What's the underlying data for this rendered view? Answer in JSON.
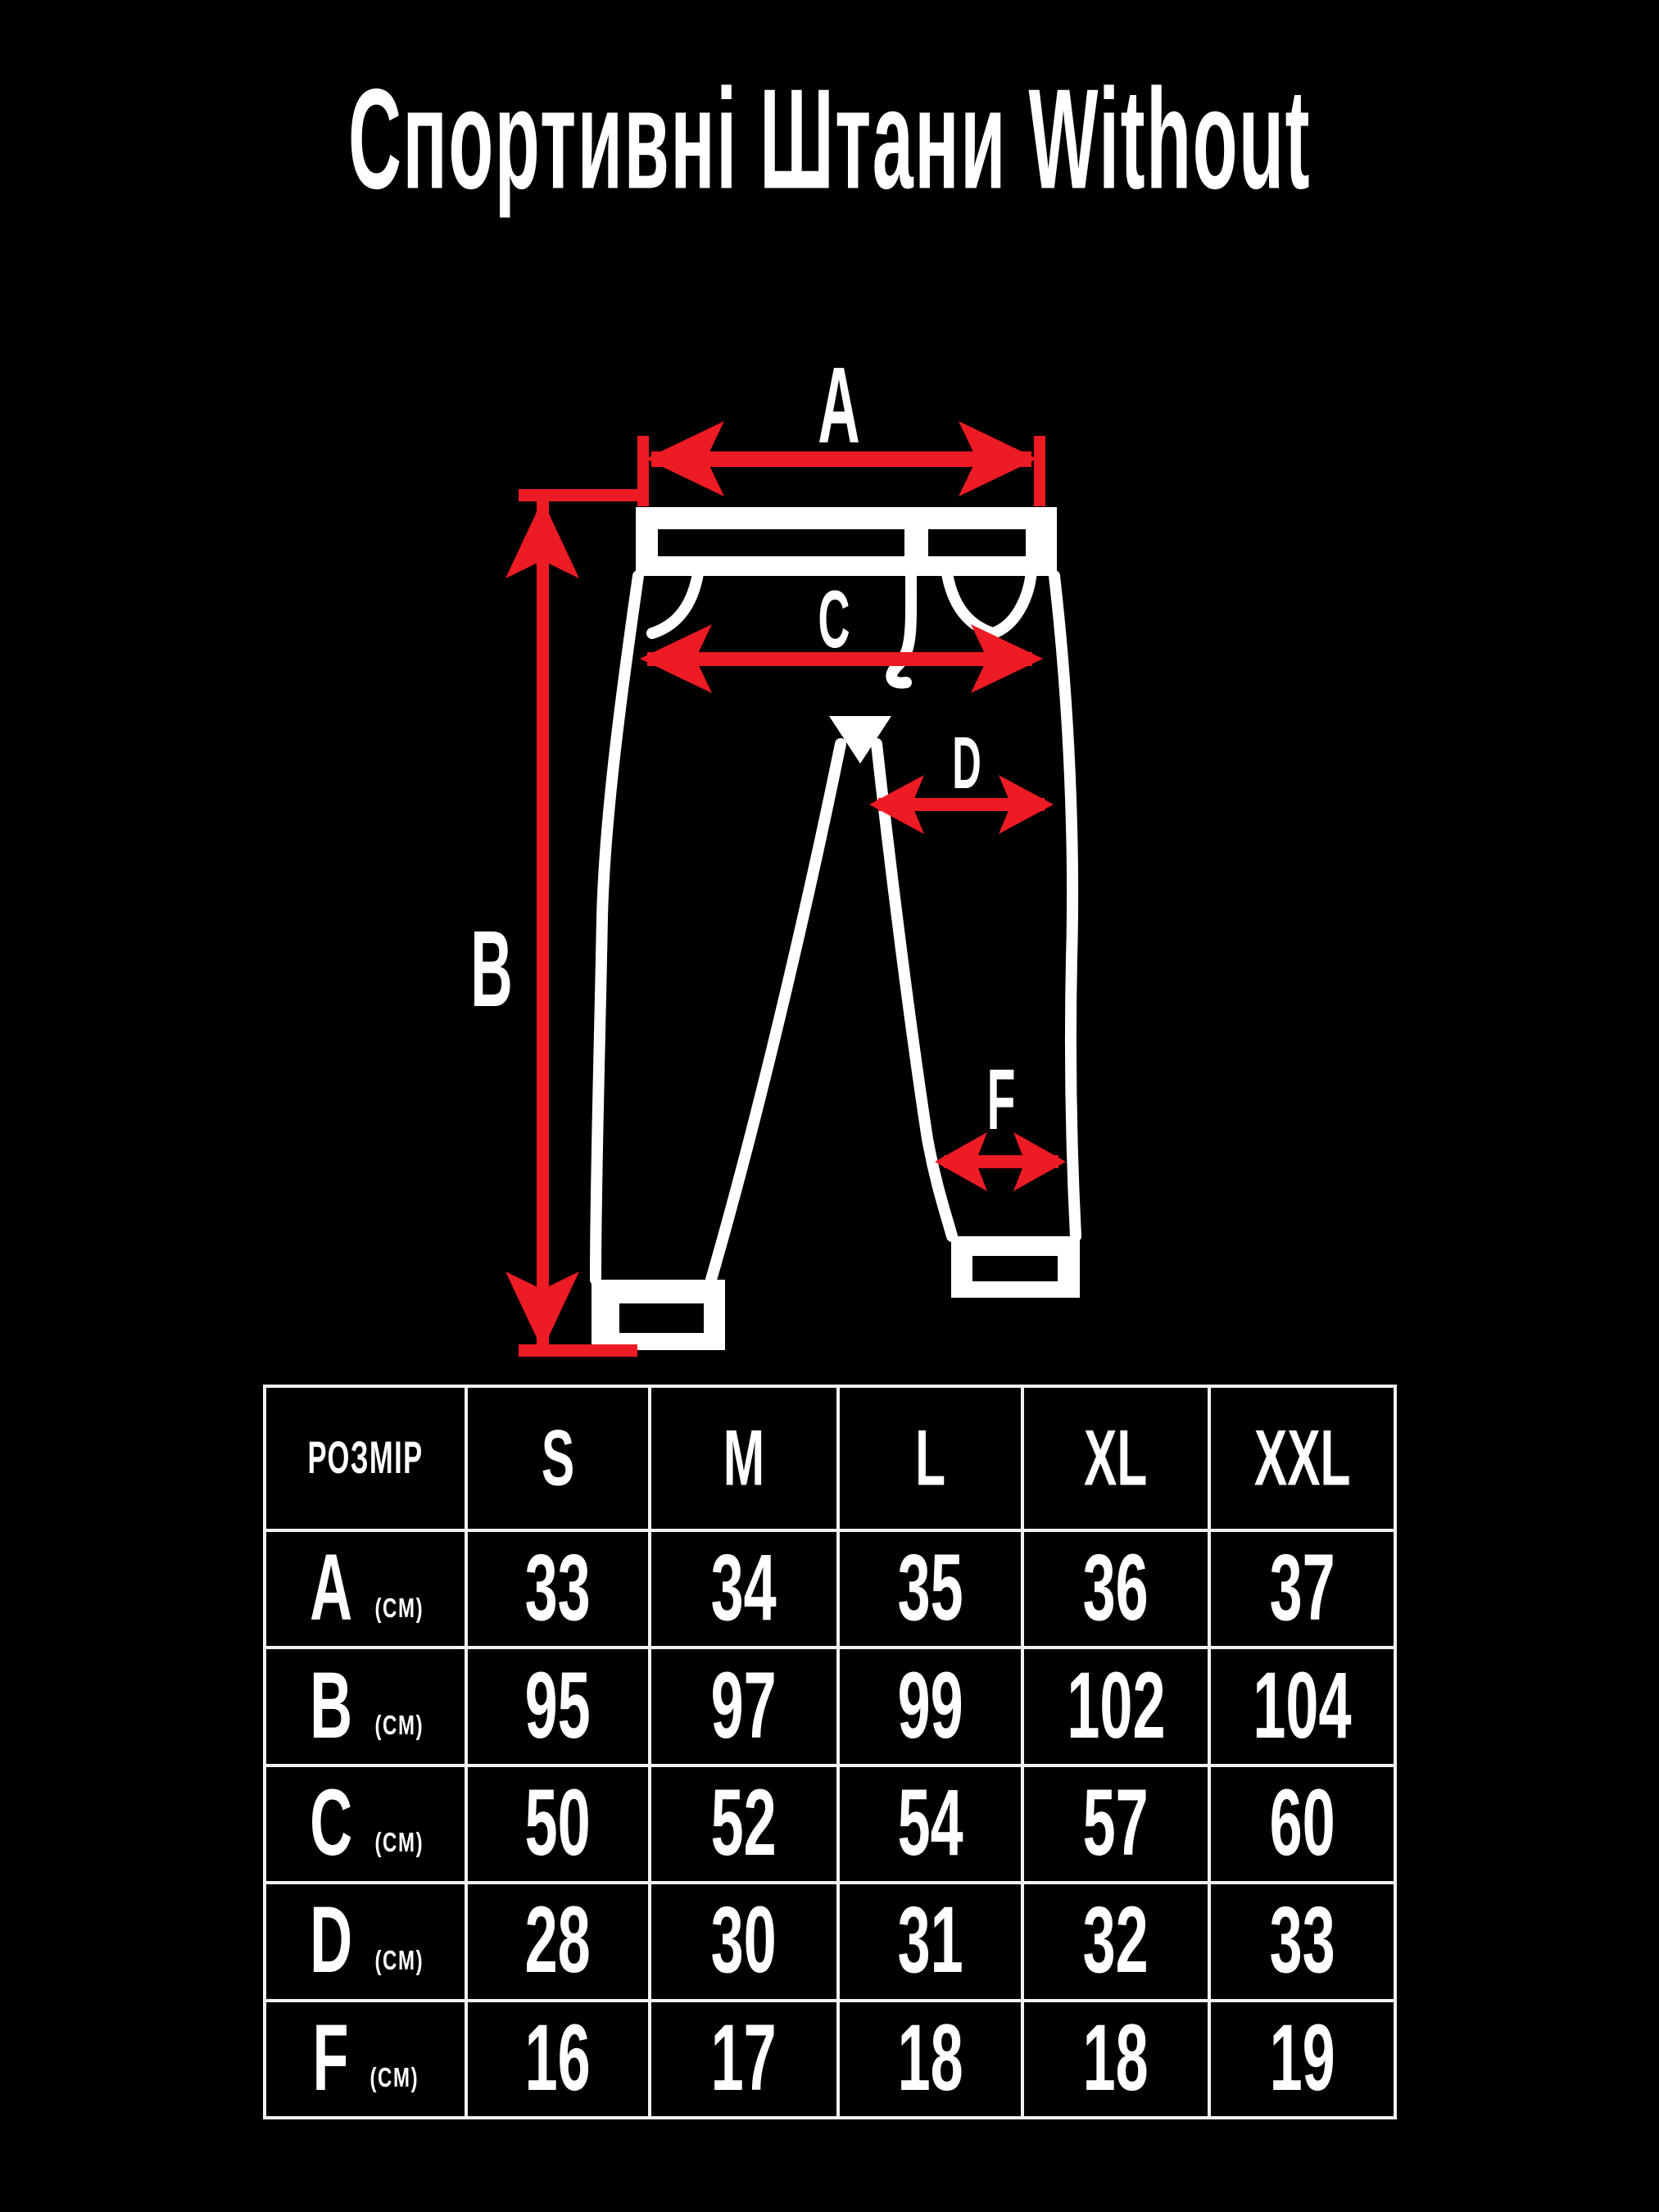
{
  "title": "Спортивні Штани Without",
  "colors": {
    "background": "#000000",
    "accent_red": "#ed1b24",
    "line_white": "#ffffff",
    "grid_white": "#f2f2ee"
  },
  "diagram": {
    "labels": {
      "A": "A",
      "B": "B",
      "C": "C",
      "D": "D",
      "F": "F"
    }
  },
  "size_table": {
    "header": {
      "size_col": "РОЗМІР",
      "sizes": [
        "S",
        "M",
        "L",
        "XL",
        "XXL"
      ]
    },
    "rows": [
      {
        "label": "A",
        "unit": "(CM)",
        "values": [
          "33",
          "34",
          "35",
          "36",
          "37"
        ]
      },
      {
        "label": "B",
        "unit": "(CM)",
        "values": [
          "95",
          "97",
          "99",
          "102",
          "104"
        ]
      },
      {
        "label": "C",
        "unit": "(CM)",
        "values": [
          "50",
          "52",
          "54",
          "57",
          "60"
        ]
      },
      {
        "label": "D",
        "unit": "(CM)",
        "values": [
          "28",
          "30",
          "31",
          "32",
          "33"
        ]
      },
      {
        "label": "F",
        "unit": "(CM)",
        "values": [
          "16",
          "17",
          "18",
          "18",
          "19"
        ]
      }
    ]
  }
}
